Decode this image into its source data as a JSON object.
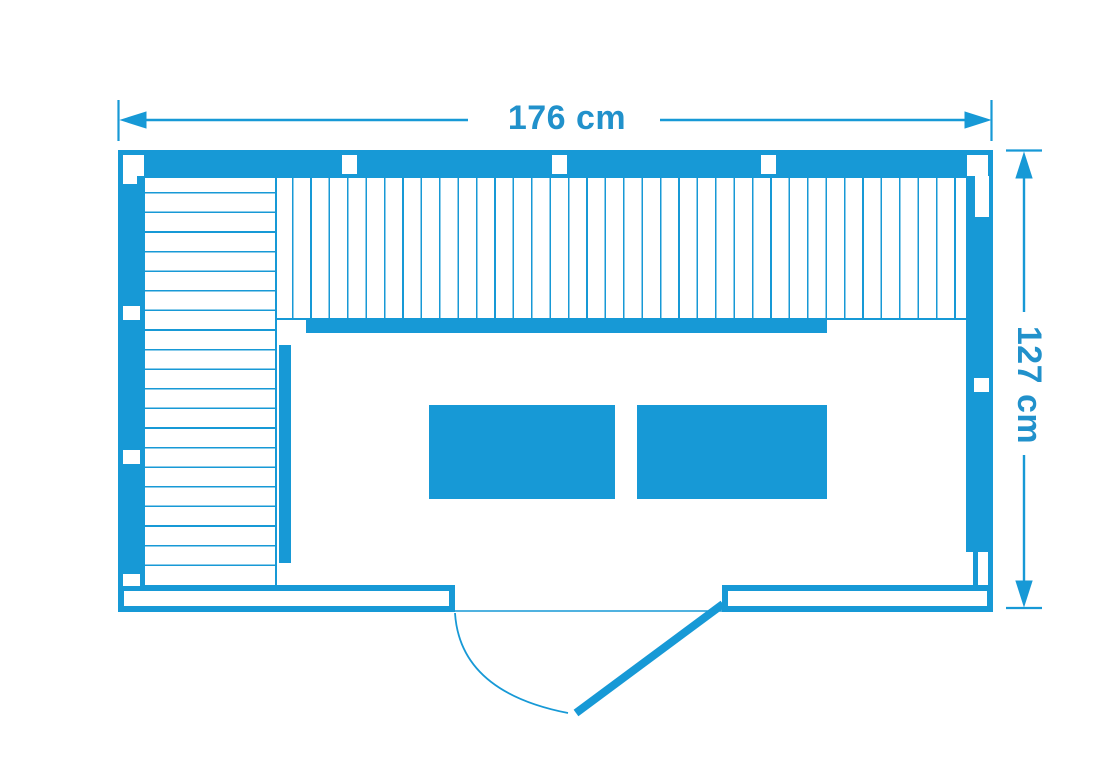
{
  "plan": {
    "kind": "floor-plan-top-view",
    "width_dimension": {
      "label": "176 cm",
      "value": 176,
      "unit": "cm"
    },
    "depth_dimension": {
      "label": "127 cm",
      "value": 127,
      "unit": "cm"
    }
  },
  "colors": {
    "accent": "#1799D6",
    "label": "#2191CB",
    "background": "#FFFFFF"
  }
}
